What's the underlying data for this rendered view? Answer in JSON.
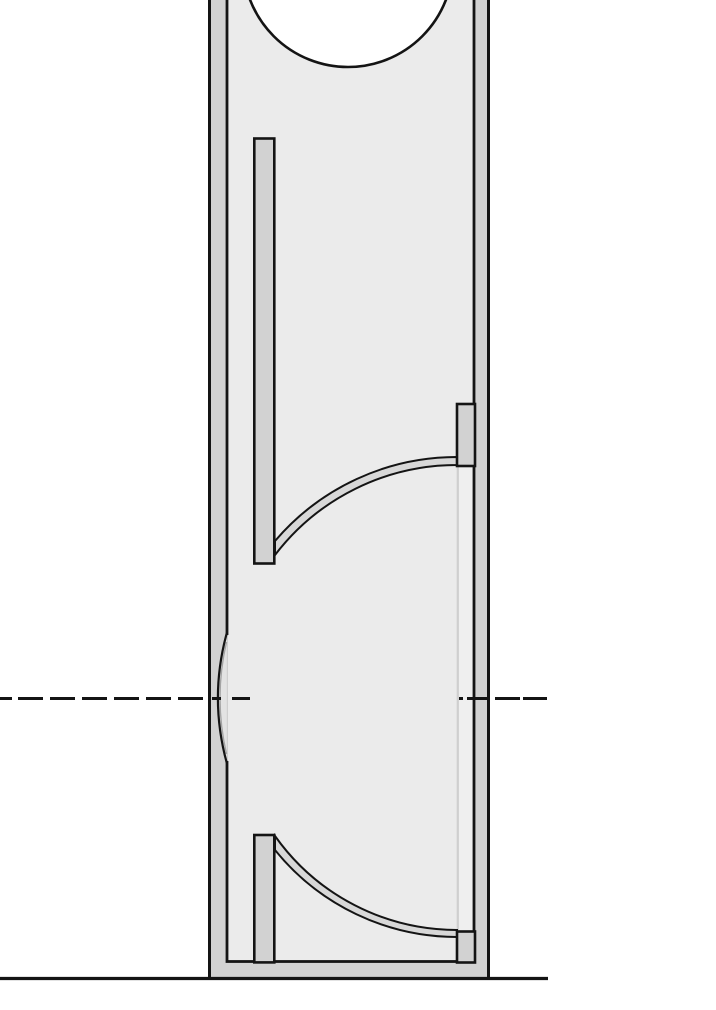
{
  "document": {
    "title": "Enclosure cross-section technical drawing",
    "type": "line-drawing",
    "view": "vertical section, cropped at top and left/right margins",
    "text_labels": []
  },
  "canvas": {
    "width": 716,
    "height": 1010
  },
  "colors": {
    "background": "#ffffff",
    "line": "#141414",
    "wall_fill": "#d2d2d2",
    "interior_fill": "#ebebeb",
    "deflector_fill": "#d8d8d8",
    "channel_fill": "#efefef",
    "port_lens_fill": "#e3e3e3",
    "thin_panel_line": "#cfcfcf"
  },
  "drawing": {
    "outer_shell": {
      "left_x": 208,
      "right_x": 490,
      "bottom_y": 978,
      "wall_thickness": 19,
      "top": "cropped-off-canvas"
    },
    "interior": {
      "left_x": 227,
      "right_x": 474,
      "floor_top_y": 961.5
    },
    "driver_cutout_circle": {
      "cx": 348,
      "cy": -38,
      "r": 105
    },
    "upper_internal_panel": {
      "x": 254,
      "y": 138.5,
      "width": 20,
      "height": 425
    },
    "lower_post_panel": {
      "x": 254,
      "y": 835,
      "width": 20,
      "height": 127
    },
    "upper_wall_block": {
      "x": 457,
      "y": 404,
      "width": 18,
      "height": 62
    },
    "lower_wall_block": {
      "x": 457,
      "y": 931.5,
      "width": 18,
      "height": 31
    },
    "upper_deflector": {
      "from": [
        275,
        541
      ],
      "to": [
        457,
        457
      ],
      "radius": 239,
      "strip_thickness": 9
    },
    "lower_deflector": {
      "from": [
        275,
        836
      ],
      "to": [
        457,
        930
      ],
      "radius": 223,
      "strip_thickness": 9
    },
    "thin_divider_line": {
      "x": 457.8,
      "y1": 467,
      "y2": 930
    },
    "side_port_lens": {
      "wall": "left",
      "span_y": [
        633,
        763
      ],
      "apex_x": 217,
      "center_y": 698
    },
    "centerline_y": 698.5,
    "ground_line": {
      "y": 978.5,
      "x1": 0,
      "x2": 548
    },
    "shapes": [
      {
        "name": "page-background",
        "kind": "rect",
        "x": 0,
        "y": 0,
        "w": 716,
        "h": 1010,
        "fill": "background"
      },
      {
        "name": "cabinet-wall-shell",
        "kind": "rect",
        "x": 209.5,
        "y": -6,
        "w": 279,
        "h": 984.5,
        "fill": "wall_fill",
        "stroke": "line",
        "sw": 3
      },
      {
        "name": "cabinet-interior",
        "kind": "rect",
        "x": 227,
        "y": -6,
        "w": 247,
        "h": 967.5,
        "fill": "interior_fill",
        "stroke": "line",
        "sw": 2.8
      },
      {
        "name": "driver-cutout-circle",
        "kind": "circle",
        "cx": 348,
        "cy": -38,
        "r": 105,
        "fill": "background",
        "stroke": "line",
        "sw": 2.6
      },
      {
        "name": "port-lens-wall-patch",
        "kind": "rect",
        "x": 224.2,
        "y": 635,
        "w": 2.9,
        "h": 126,
        "fill": "wall_fill"
      },
      {
        "name": "port-lens-interior-patch",
        "kind": "rect",
        "x": 227.1,
        "y": 635,
        "w": 2.9,
        "h": 126,
        "fill": "interior_fill"
      },
      {
        "name": "port-lens-faint-edge",
        "kind": "line",
        "x1": 227.2,
        "y1": 635,
        "x2": 227.2,
        "y2": 761,
        "stroke": "thin_panel_line",
        "sw": 1.6
      },
      {
        "name": "port-lens-body",
        "kind": "path",
        "d": "M226.8,633 Q209,698 226.8,763 Z",
        "fill": "port_lens_fill"
      },
      {
        "name": "port-lens-shadow-arc",
        "kind": "path",
        "d": "M226.5,642 Q213.5,698 226.5,754",
        "stroke": "line",
        "sw": 1.4,
        "opacity": 0.3
      },
      {
        "name": "port-lens-arc",
        "kind": "path",
        "d": "M226.8,633 Q209,698 226.8,763",
        "stroke": "line",
        "sw": 2.2
      },
      {
        "name": "right-channel-strip",
        "kind": "rect",
        "x": 458.9,
        "y": 467,
        "w": 13.6,
        "h": 463,
        "fill": "channel_fill"
      },
      {
        "name": "thin-divider-line",
        "kind": "line",
        "x1": 457.8,
        "y1": 467,
        "x2": 457.8,
        "y2": 930,
        "stroke": "thin_panel_line",
        "sw": 2.2
      },
      {
        "name": "upper-deflector-strip",
        "kind": "path",
        "d": "M275,541 A239,239 0 0 1 457,457 L457,465 A229,229 0 0 0 275,555 Z",
        "fill": "deflector_fill",
        "stroke": "line",
        "sw": 2
      },
      {
        "name": "lower-deflector-strip",
        "kind": "path",
        "d": "M275,836 A223,223 0 0 0 457,930 L457,937 A234,234 0 0 1 275,850 Z",
        "fill": "deflector_fill",
        "stroke": "line",
        "sw": 2
      },
      {
        "name": "upper-internal-panel",
        "kind": "rect",
        "x": 254.3,
        "y": 138.5,
        "w": 20,
        "h": 425,
        "fill": "wall_fill",
        "stroke": "line",
        "sw": 2.6
      },
      {
        "name": "lower-post-panel",
        "kind": "rect",
        "x": 254.3,
        "y": 835,
        "w": 20,
        "h": 127.4,
        "fill": "wall_fill",
        "stroke": "line",
        "sw": 2.6
      },
      {
        "name": "upper-wall-block",
        "kind": "rect",
        "x": 457,
        "y": 404,
        "w": 18,
        "h": 62,
        "fill": "wall_fill",
        "stroke": "line",
        "sw": 2.6
      },
      {
        "name": "lower-wall-block",
        "kind": "rect",
        "x": 457,
        "y": 931.5,
        "w": 18,
        "h": 31,
        "fill": "wall_fill",
        "stroke": "line",
        "sw": 2.6
      },
      {
        "name": "horizontal-centerline",
        "kind": "segments",
        "y": 698.5,
        "segs": [
          [
            0,
            12
          ],
          [
            18,
            43
          ],
          [
            50,
            75
          ],
          [
            82,
            107
          ],
          [
            114,
            139
          ],
          [
            146,
            171
          ],
          [
            178,
            203
          ],
          [
            212,
            221
          ],
          [
            232,
            250
          ],
          [
            459,
            463
          ],
          [
            467,
            490
          ],
          [
            495,
            520
          ],
          [
            523,
            547
          ]
        ],
        "stroke": "line",
        "sw": 3
      },
      {
        "name": "ground-line",
        "kind": "line",
        "x1": 0,
        "y1": 978.5,
        "x2": 548,
        "y2": 978.5,
        "stroke": "line",
        "sw": 3.2
      }
    ]
  }
}
